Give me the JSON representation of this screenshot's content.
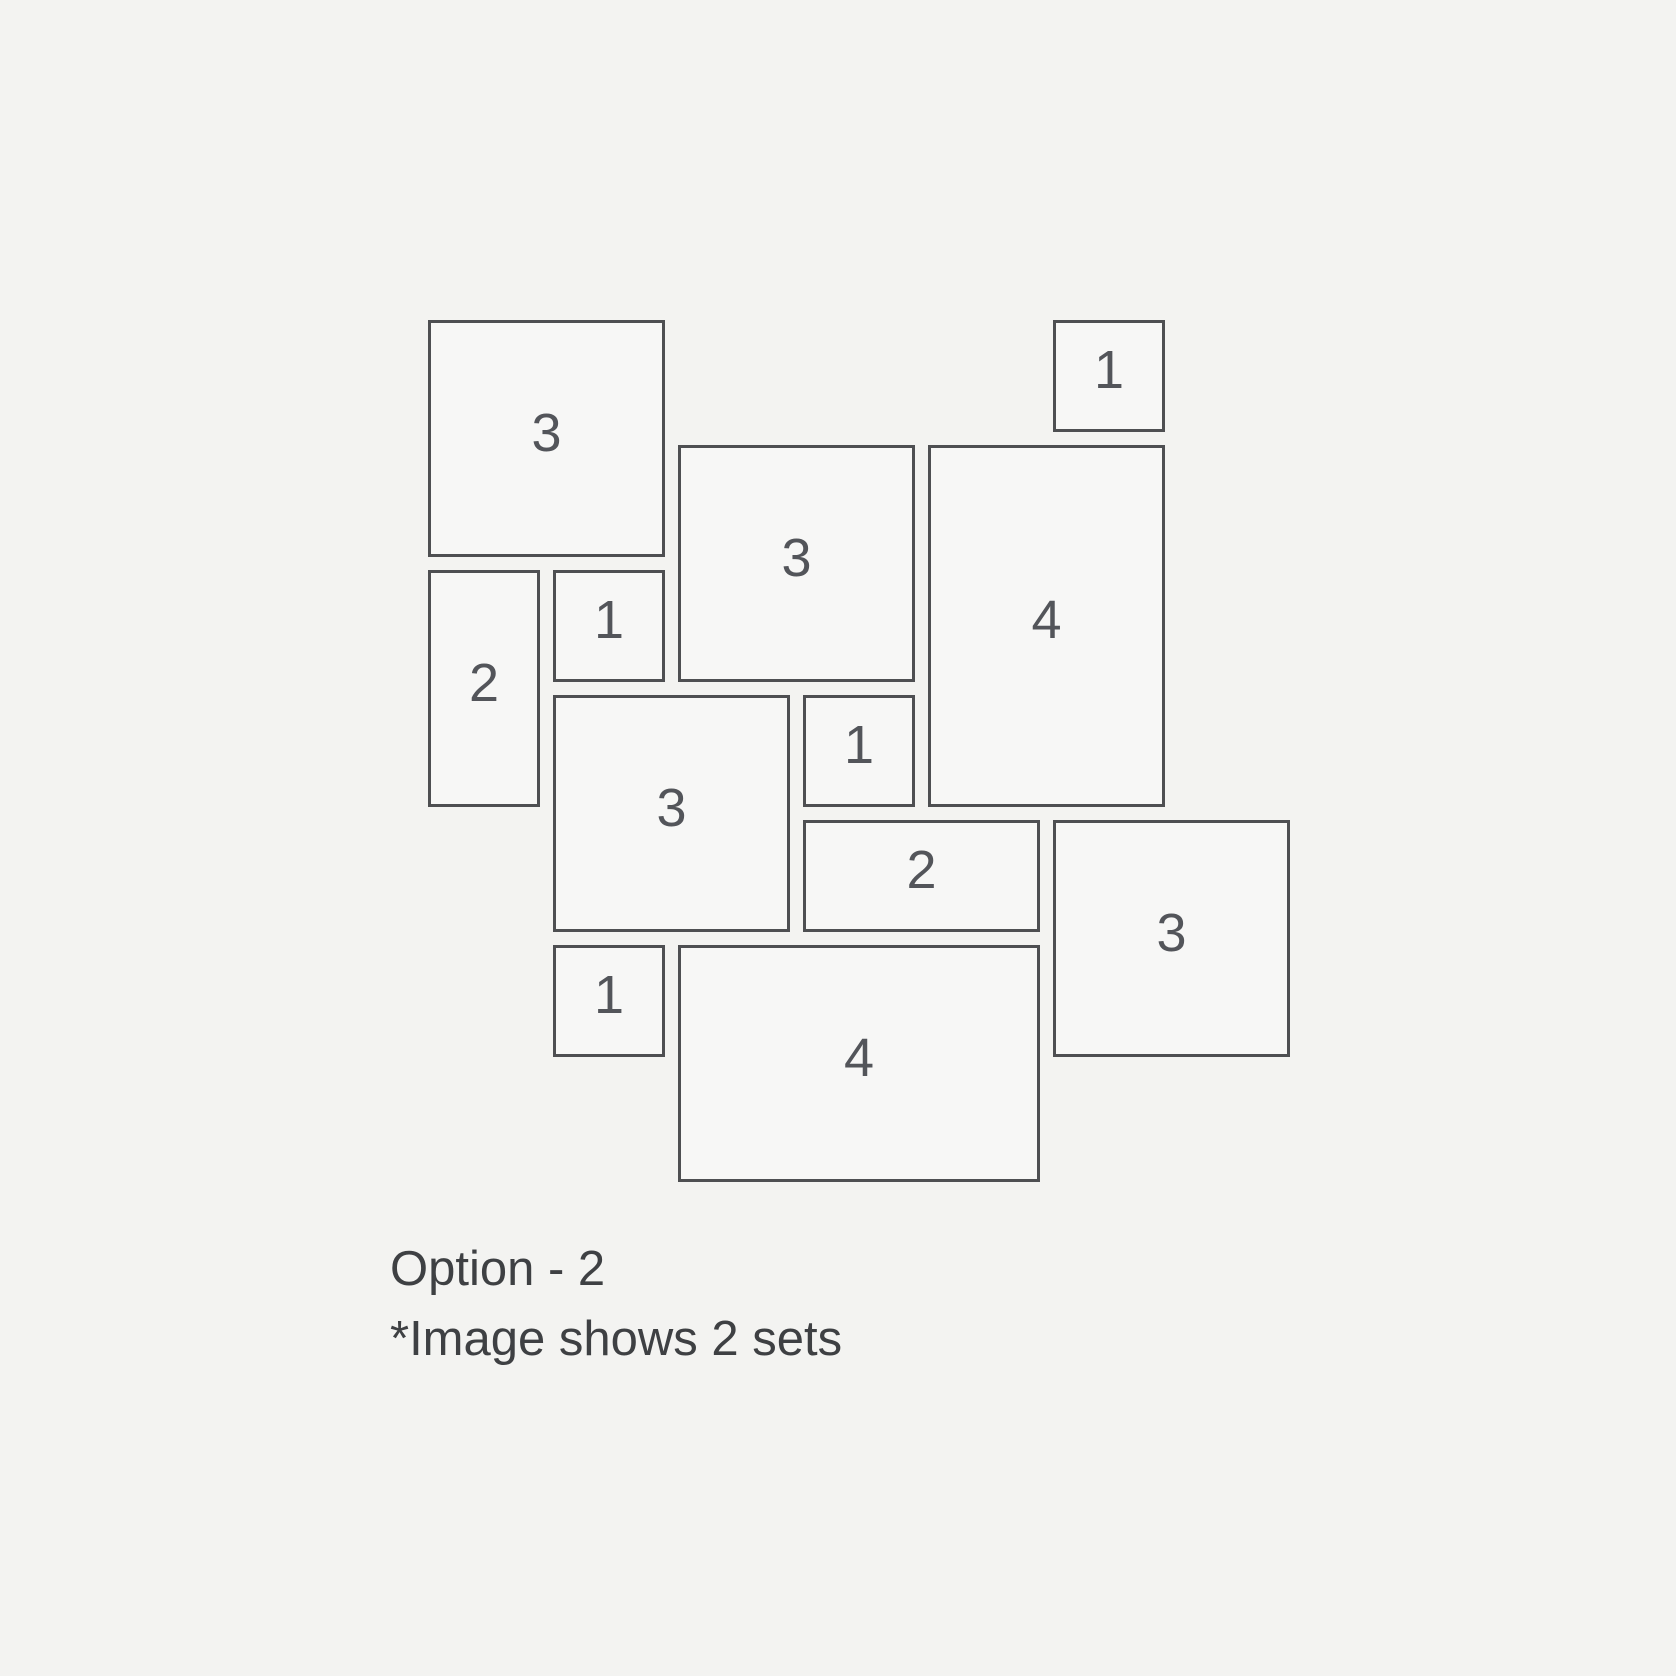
{
  "page": {
    "background_color": "#f3f3f1"
  },
  "diagram": {
    "description": "frame-set-layout-plan",
    "grid": {
      "origin_x": 428,
      "origin_y": 320,
      "unit_px": 112,
      "gap_px": 13
    },
    "colors": {
      "tile_fill": "#f7f7f6",
      "tile_border": "#4e4f52",
      "number_text": "#53555a",
      "caption_text": "#3e4043"
    },
    "tiles": [
      {
        "id": "tile-3-top-left",
        "label": "3",
        "col": 0,
        "row": 0,
        "cols": 2,
        "rows": 2
      },
      {
        "id": "tile-1-top-right",
        "label": "1",
        "col": 5,
        "row": 0,
        "cols": 1,
        "rows": 1
      },
      {
        "id": "tile-3-upper-middle",
        "label": "3",
        "col": 2,
        "row": 1,
        "cols": 2,
        "rows": 2
      },
      {
        "id": "tile-4-right",
        "label": "4",
        "col": 4,
        "row": 1,
        "cols": 2,
        "rows": 3
      },
      {
        "id": "tile-2-left",
        "label": "2",
        "col": 0,
        "row": 2,
        "cols": 1,
        "rows": 2
      },
      {
        "id": "tile-1-upper-left",
        "label": "1",
        "col": 1,
        "row": 2,
        "cols": 1,
        "rows": 1
      },
      {
        "id": "tile-3-center",
        "label": "3",
        "col": 1,
        "row": 3,
        "cols": 2,
        "rows": 2
      },
      {
        "id": "tile-1-center",
        "label": "1",
        "col": 3,
        "row": 3,
        "cols": 1,
        "rows": 1
      },
      {
        "id": "tile-2-middle",
        "label": "2",
        "col": 3,
        "row": 4,
        "cols": 2,
        "rows": 1
      },
      {
        "id": "tile-3-bottom-right",
        "label": "3",
        "col": 5,
        "row": 4,
        "cols": 2,
        "rows": 2
      },
      {
        "id": "tile-1-bottom-left",
        "label": "1",
        "col": 1,
        "row": 5,
        "cols": 1,
        "rows": 1
      },
      {
        "id": "tile-4-bottom",
        "label": "4",
        "col": 2,
        "row": 5,
        "cols": 3,
        "rows": 2
      }
    ]
  },
  "caption": {
    "line1": "Option - 2",
    "line2": "*Image shows 2 sets"
  }
}
